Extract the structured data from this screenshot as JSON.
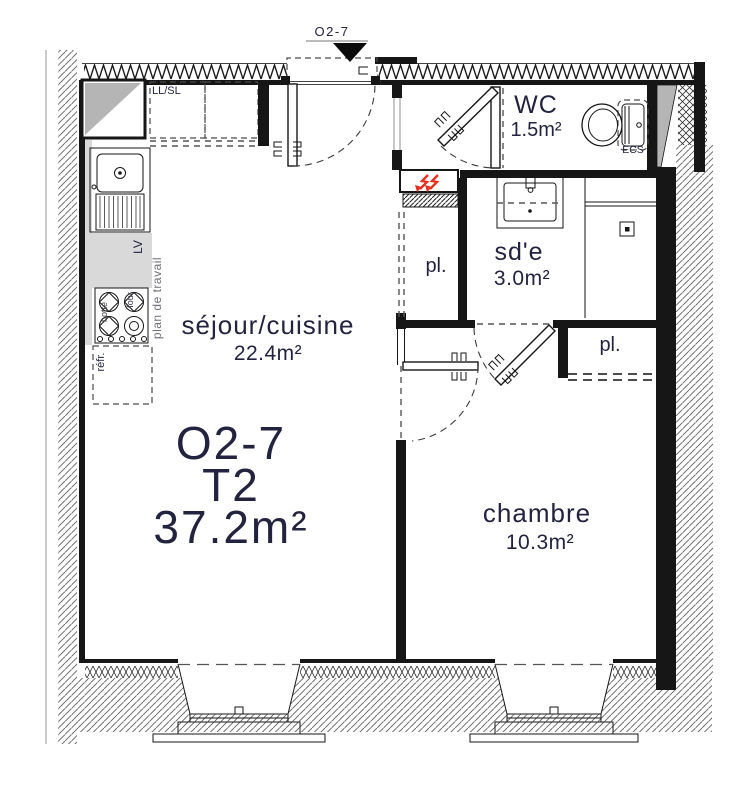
{
  "plan": {
    "top_label": "O2-7",
    "unit": {
      "id": "O2-7",
      "type": "T2",
      "area": "37.2m²"
    },
    "rooms": {
      "sejour": {
        "name": "séjour/cuisine",
        "area": "22.4m²"
      },
      "chambre": {
        "name": "chambre",
        "area": "10.3m²"
      },
      "wc": {
        "name": "WC",
        "area": "1.5m²"
      },
      "sde": {
        "name": "sd'e",
        "area": "3.0m²"
      },
      "closet_sde": {
        "name": "pl."
      },
      "closet_chambre": {
        "name": "pl."
      }
    },
    "annotations": {
      "llsl": "LL/SL",
      "lv": "LV",
      "plan_de_travail": "plan de travail",
      "refr": "réfr.",
      "hotte": "hotte",
      "four": "four",
      "ecs": "ECS"
    },
    "colors": {
      "text_navy": "#23233f",
      "wall_black": "#161616",
      "radiator_red": "#e53222",
      "shaft_gray": "#b5b5b5",
      "counter_gray": "#d9d9d9"
    }
  }
}
